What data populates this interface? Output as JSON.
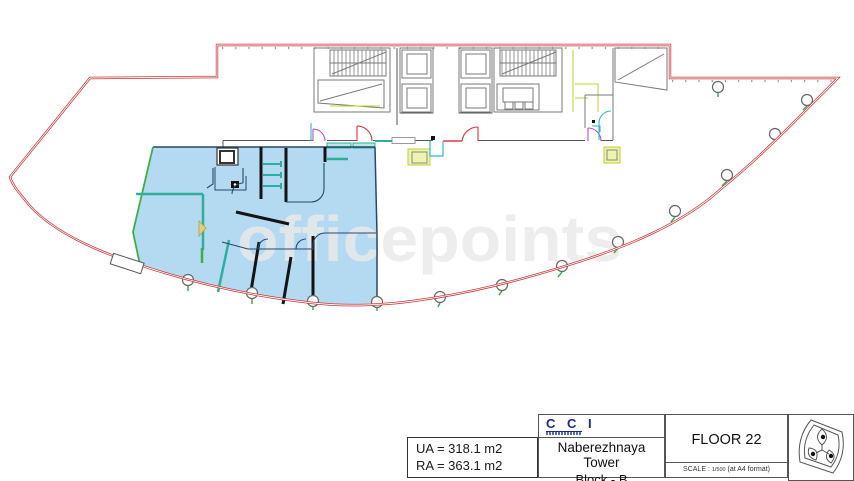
{
  "watermark": {
    "text": "officepoints"
  },
  "plan": {
    "highlight_color": "#b3daf0",
    "perimeter_color": "#c93636",
    "partition_teal": "#2fae9b",
    "boundary_green": "#3fae4a",
    "accent_chartreuse": "#bcd32e",
    "door_magenta": "#c24ec2",
    "door_cyan": "#2bb9cf"
  },
  "info_box": {
    "ua": "UA = 318.1 m2",
    "ra": "RA = 363.1 m2"
  },
  "title_block": {
    "company_logo": "C C I",
    "building": "Naberezhnaya Tower",
    "block": "Block - B",
    "floor": "FLOOR 22",
    "scale_prefix": "SCALE : ",
    "scale_ratio": "1/500",
    "scale_suffix": " (at A4 format)"
  }
}
